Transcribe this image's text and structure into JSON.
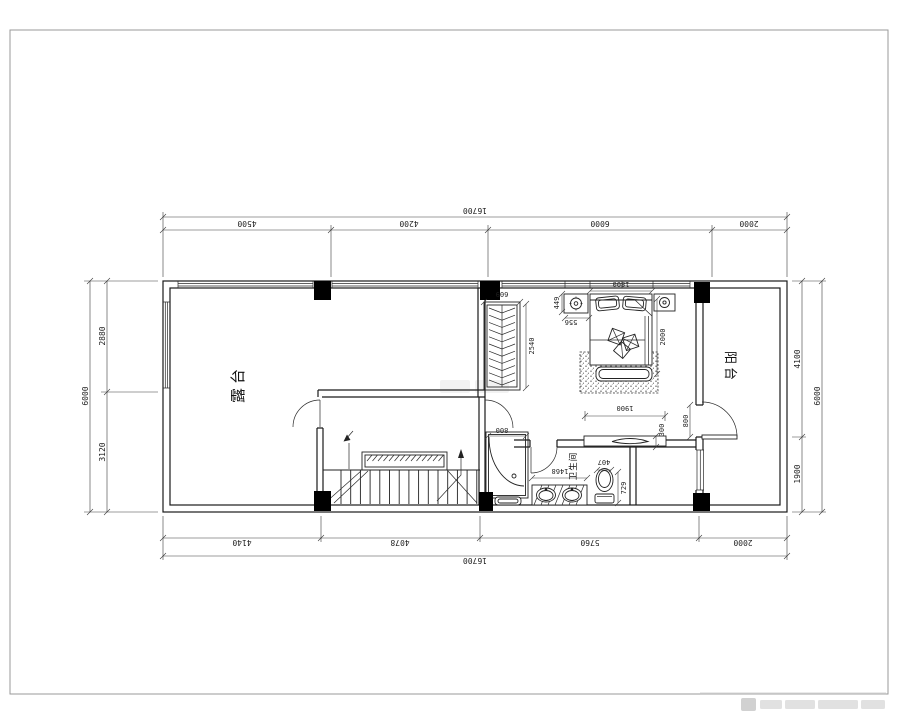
{
  "drawing": {
    "type": "floor-plan",
    "rooms": {
      "terrace": "露台",
      "balcony": "阳台",
      "bathroom": "卫生间"
    },
    "dimensions": {
      "top": {
        "total": "16700",
        "segments": [
          "4500",
          "4200",
          "6000",
          "2000"
        ]
      },
      "bottom": {
        "total": "16700",
        "segments": [
          "4140",
          "4078",
          "5760",
          "2000"
        ]
      },
      "left": {
        "total": "6000",
        "upper": "2880",
        "lower": "3120"
      },
      "right": {
        "total": "6000",
        "upper": "4100",
        "lower": "1900"
      },
      "interior": {
        "wardrobe_depth": "609",
        "wardrobe_length": "2540",
        "nightstand_depth": "449",
        "nightstand_width": "556",
        "bed_width": "1800",
        "bed_length": "2000",
        "tv_cabinet_length": "1900",
        "tv_cabinet_depth": "300",
        "shower_width": "800",
        "balcony_door_width": "800",
        "vanity_length": "1468",
        "toilet_width": "407",
        "toilet_length": "729"
      }
    },
    "line_color": "#1a1a1a",
    "border_color": "#9a9a9a"
  }
}
